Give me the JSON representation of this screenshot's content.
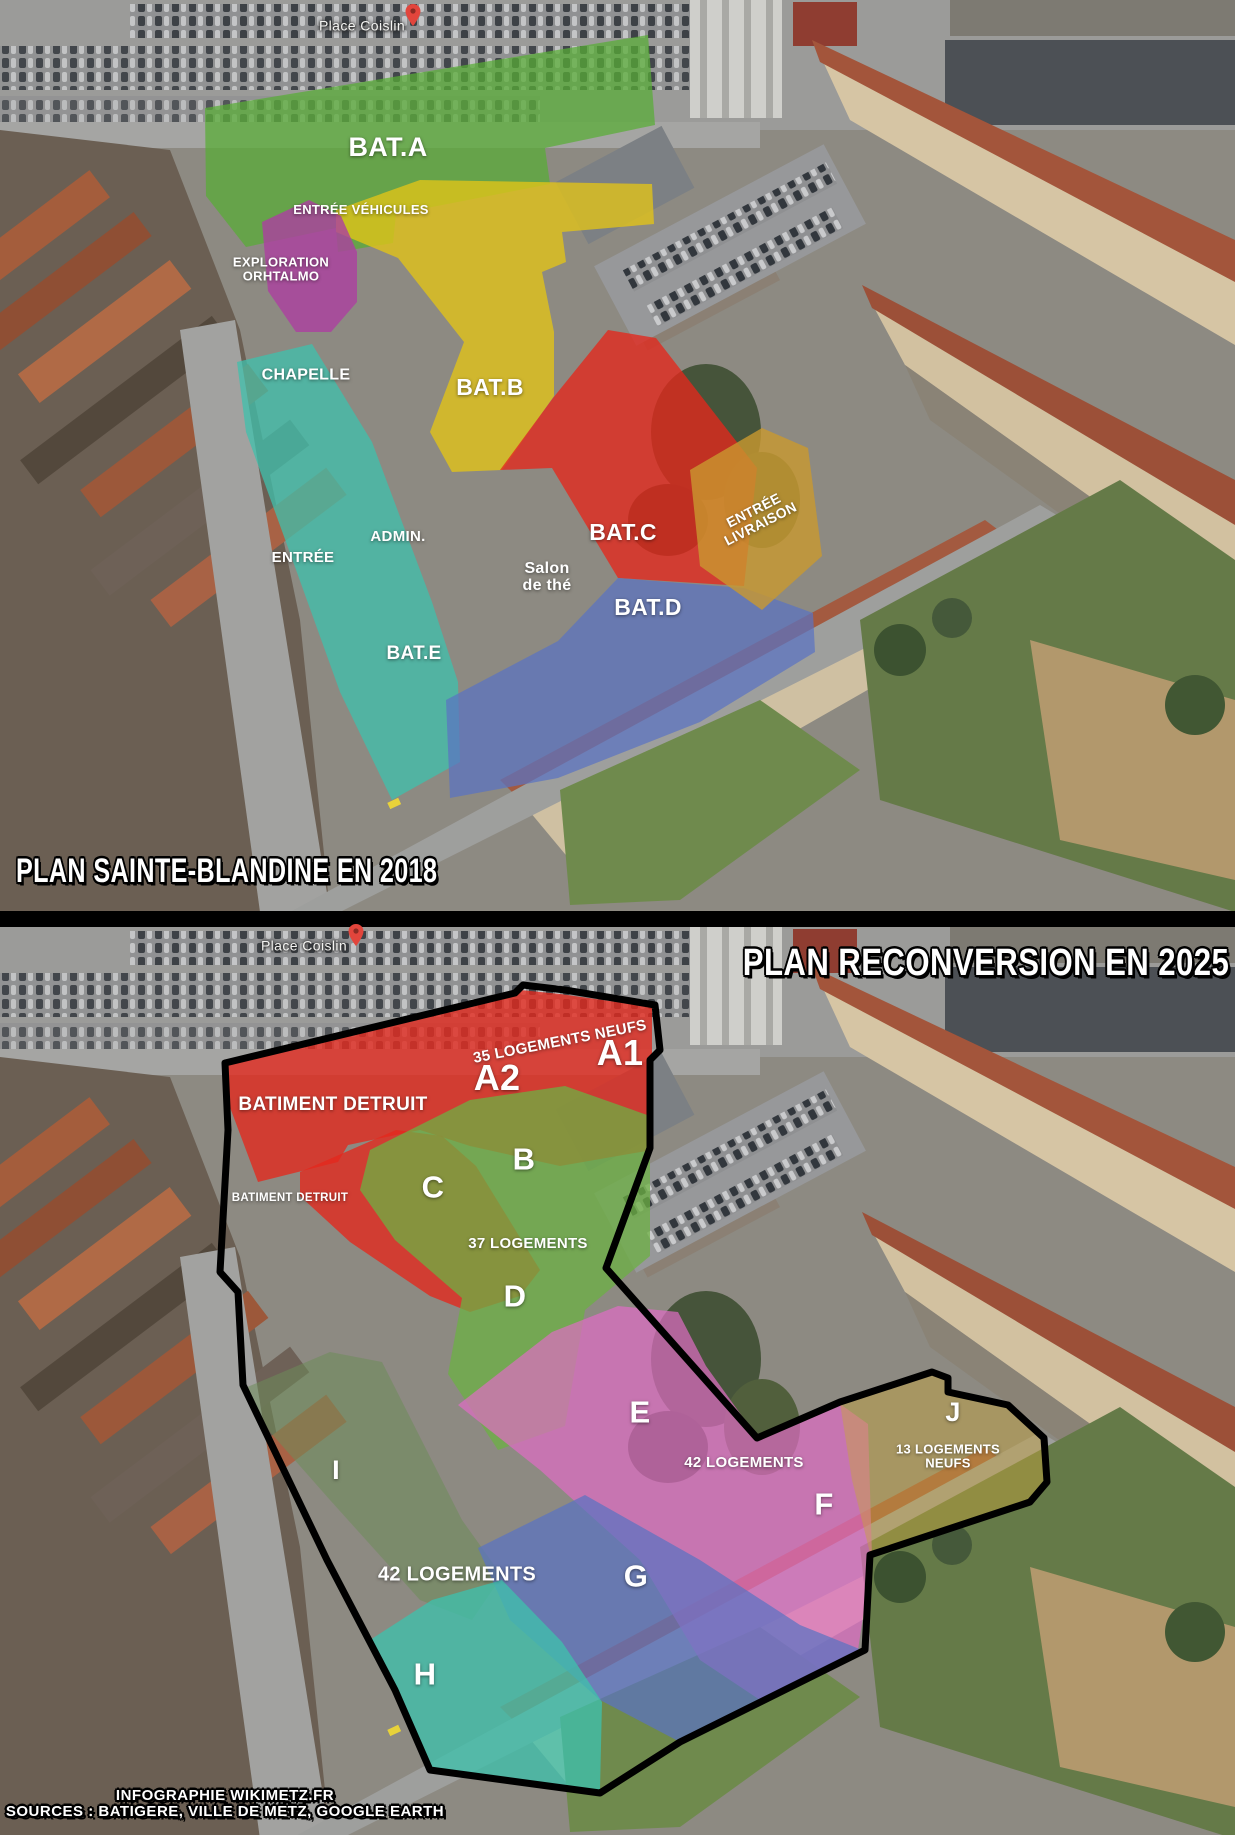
{
  "meta": {
    "description": "Infographic over Google Earth aerial view comparing the Sainte-Blandine site in 2018 with the 2025 reconversion plan",
    "panels": [
      "2018 plan",
      "2025 reconversion plan"
    ]
  },
  "top": {
    "map_place_label": "Place Coislin",
    "title": "PLAN SAINTE-BLANDINE EN 2018",
    "bat_a": "BAT.A",
    "entree_vehicules": "ENTRÉE VÉHICULES",
    "exploration_l1": "EXPLORATION",
    "exploration_l2": "ORHTALMO",
    "chapelle": "CHAPELLE",
    "bat_b": "BAT.B",
    "admin": "ADMIN.",
    "entree": "ENTRÉE",
    "salon_l1": "Salon",
    "salon_l2": "de thé",
    "bat_c": "BAT.C",
    "bat_d": "BAT.D",
    "bat_e": "BAT.E",
    "entree_livraison_l1": "ENTRÉE",
    "entree_livraison_l2": "LIVRAISON"
  },
  "bottom": {
    "map_place_label": "Place Coislin",
    "title": "PLAN RECONVERSION EN 2025",
    "batiment_detruit_big": "BATIMENT DETRUIT",
    "batiment_detruit_small": "BATIMENT DETRUIT",
    "logements_35": "35 LOGEMENTS NEUFS",
    "a1": "A1",
    "a2": "A2",
    "b": "B",
    "c": "C",
    "d": "D",
    "e": "E",
    "f": "F",
    "g": "G",
    "h": "H",
    "i": "I",
    "j": "J",
    "logements_37": "37 LOGEMENTS",
    "logements_42_pink": "42 LOGEMENTS",
    "logements_42_white": "42 LOGEMENTS",
    "logements_13_l1": "13 LOGEMENTS",
    "logements_13_l2": "NEUFS",
    "credits_l1": "INFOGRAPHIE WIKIMETZ.FR",
    "credits_l2": "SOURCES : BATIGERE, VILLE DE METZ, GOOGLE EARTH"
  },
  "colors": {
    "overlay_green": "#58ad35",
    "overlay_yellow": "#e3c417",
    "overlay_magenta": "#ad3fa0",
    "overlay_teal": "#3fc0ac",
    "overlay_red": "#e4281c",
    "overlay_blue": "#5a73c2",
    "overlay_gold": "#c9992f",
    "overlay_pink": "#e06cc4",
    "overlay_tan": "#c7a33c",
    "overlay_olive": "#6e8c5a",
    "site_boundary": "#000000",
    "map_pin": "#e2453c",
    "label_text": "#ffffff"
  }
}
